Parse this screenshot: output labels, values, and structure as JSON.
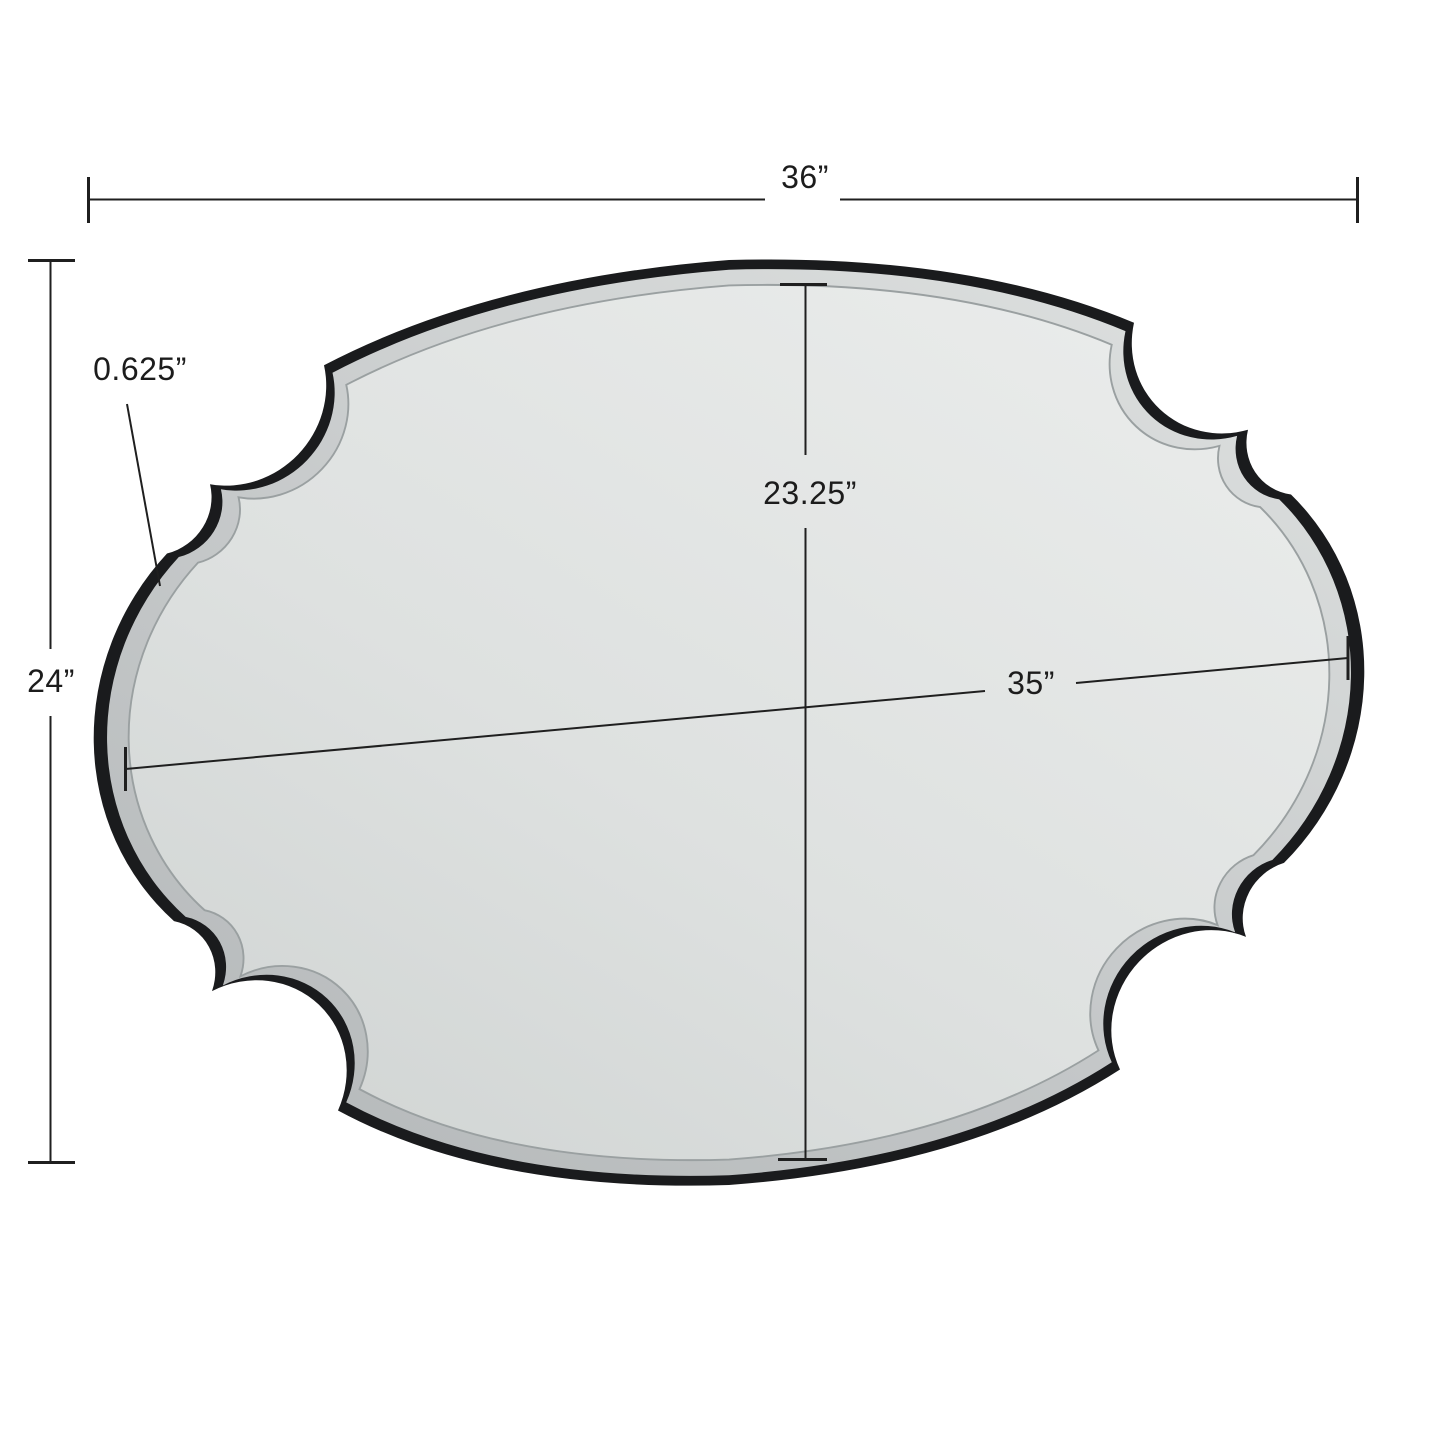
{
  "diagram": {
    "description": "Scalloped oval wall mirror with black frame, shown with measurement annotations",
    "frame_color": "#1a1b1d",
    "glass_color": "#dfe2e1",
    "bevel_color": "#c3c7c8",
    "line_color": "#1f1f1f",
    "dimensions": {
      "outer_width": {
        "label": "36”"
      },
      "outer_height": {
        "label": "24”"
      },
      "frame_depth": {
        "label": "0.625”"
      },
      "glass_height": {
        "label": "23.25”"
      },
      "glass_width": {
        "label": "35”"
      }
    }
  }
}
